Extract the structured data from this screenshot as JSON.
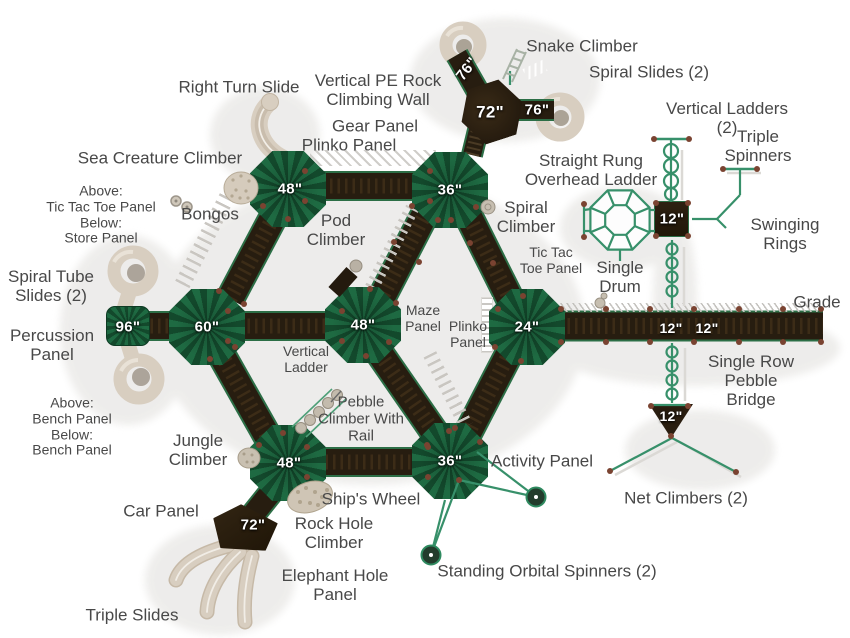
{
  "diagram": {
    "type": "playground-equipment-top-view-plan",
    "annotations": [
      {
        "text": "Snake Climber",
        "x": 582,
        "y": 46
      },
      {
        "text": "Spiral Slides (2)",
        "x": 649,
        "y": 72
      },
      {
        "text": "Right Turn Slide",
        "x": 239,
        "y": 87
      },
      {
        "text": "Vertical PE Rock\nClimbing Wall",
        "x": 378,
        "y": 90
      },
      {
        "text": "Gear Panel",
        "x": 375,
        "y": 126
      },
      {
        "text": "Plinko Panel",
        "x": 349,
        "y": 145
      },
      {
        "text": "Vertical Ladders (2)",
        "x": 727,
        "y": 118
      },
      {
        "text": "Triple Spinners",
        "x": 758,
        "y": 146
      },
      {
        "text": "Sea Creature Climber",
        "x": 160,
        "y": 158
      },
      {
        "text": "Straight Rung\nOverhead Ladder",
        "x": 591,
        "y": 170
      },
      {
        "text": "Above:\nTic Tac Toe Panel\nBelow:\nStore Panel",
        "x": 101,
        "y": 215,
        "size": 14
      },
      {
        "text": "Bongos",
        "x": 210,
        "y": 214
      },
      {
        "text": "Pod\nClimber",
        "x": 336,
        "y": 230
      },
      {
        "text": "Spiral\nClimber",
        "x": 526,
        "y": 217
      },
      {
        "text": "Swinging\nRings",
        "x": 785,
        "y": 234
      },
      {
        "text": "Tic Tac\nToe Panel",
        "x": 551,
        "y": 261,
        "size": 14
      },
      {
        "text": "Single\nDrum",
        "x": 620,
        "y": 277
      },
      {
        "text": "Spiral Tube\nSlides (2)",
        "x": 51,
        "y": 286
      },
      {
        "text": "Grade",
        "x": 817,
        "y": 302
      },
      {
        "text": "Percussion\nPanel",
        "x": 52,
        "y": 345
      },
      {
        "text": "Maze\nPanel",
        "x": 423,
        "y": 319,
        "size": 14
      },
      {
        "text": "Plinko\nPanel",
        "x": 468,
        "y": 335,
        "size": 14
      },
      {
        "text": "Vertical\nLadder",
        "x": 306,
        "y": 360,
        "size": 14
      },
      {
        "text": "Above:\nBench Panel\nBelow:\nBench Panel",
        "x": 72,
        "y": 427,
        "size": 14
      },
      {
        "text": "Single Row\nPebble Bridge",
        "x": 751,
        "y": 381
      },
      {
        "text": "Pebble\nClimber With\nRail",
        "x": 361,
        "y": 420,
        "size": 15
      },
      {
        "text": "Jungle\nClimber",
        "x": 198,
        "y": 450
      },
      {
        "text": "Activity Panel",
        "x": 542,
        "y": 461
      },
      {
        "text": "Net Climbers (2)",
        "x": 686,
        "y": 498
      },
      {
        "text": "Car Panel",
        "x": 161,
        "y": 511
      },
      {
        "text": "Ship's Wheel",
        "x": 371,
        "y": 499
      },
      {
        "text": "Rock Hole\nClimber",
        "x": 334,
        "y": 533
      },
      {
        "text": "Standing Orbital Spinners (2)",
        "x": 547,
        "y": 571
      },
      {
        "text": "Elephant Hole\nPanel",
        "x": 335,
        "y": 585
      },
      {
        "text": "Triple Slides",
        "x": 132,
        "y": 615
      }
    ],
    "deck_labels": [
      {
        "text": "76\"",
        "x": 467,
        "y": 69,
        "rotate": -52
      },
      {
        "text": "72\"",
        "x": 490,
        "y": 112,
        "size": 17
      },
      {
        "text": "76\"",
        "x": 537,
        "y": 110
      },
      {
        "text": "48\"",
        "x": 290,
        "y": 189
      },
      {
        "text": "36\"",
        "x": 450,
        "y": 190
      },
      {
        "text": "12\"",
        "x": 672,
        "y": 219
      },
      {
        "text": "96\"",
        "x": 128,
        "y": 327
      },
      {
        "text": "60\"",
        "x": 207,
        "y": 327
      },
      {
        "text": "48\"",
        "x": 363,
        "y": 325
      },
      {
        "text": "24\"",
        "x": 527,
        "y": 327
      },
      {
        "text": "12\"",
        "x": 671,
        "y": 328,
        "size": 14
      },
      {
        "text": "12\"",
        "x": 707,
        "y": 328,
        "size": 14
      },
      {
        "text": "48\"",
        "x": 289,
        "y": 463
      },
      {
        "text": "36\"",
        "x": 450,
        "y": 461
      },
      {
        "text": "72\"",
        "x": 253,
        "y": 525
      },
      {
        "text": "12\"",
        "x": 671,
        "y": 416,
        "size": 14
      }
    ],
    "colors": {
      "roof_green_light": "#1e6a42",
      "roof_green_dark": "#13492c",
      "walkway_brown": "#271d10",
      "walkway_edge_green": "#2c6e46",
      "structure_green": "#37906a",
      "slide_beige": "#d8cec0",
      "label_gray": "#484848",
      "post_dot_brown": "#7a4331",
      "deck_label_white": "#ffffff"
    }
  }
}
